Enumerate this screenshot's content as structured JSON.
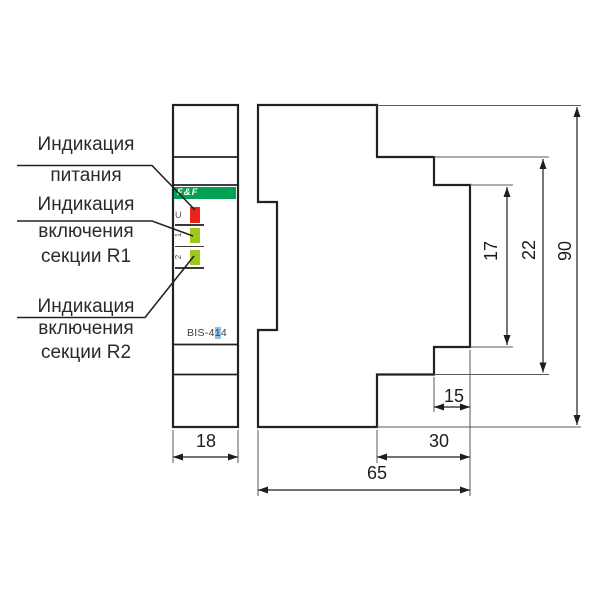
{
  "annotations": {
    "label_power": {
      "line1": "Индикация",
      "line2": "питания"
    },
    "label_r1": {
      "line1": "Индикация",
      "line2": "включения",
      "line3": "секции R1"
    },
    "label_r2": {
      "line1": "Индикация",
      "line2": "включения",
      "line3": "секции R2"
    }
  },
  "device": {
    "brand_logo": "F&F",
    "model_prefix": "BIS-4",
    "model_mid": "1",
    "model_suffix": "4",
    "led_u_label": "U",
    "led_r1_label": "1",
    "led_r2_label": "2",
    "colors": {
      "brand_green": "#00A151",
      "led_red": "#E8251D",
      "led_green": "#9DC81E",
      "model_highlight_blue": "#8CC0E8"
    }
  },
  "dimensions": {
    "front_width_mm": "18",
    "terminal_height_mm": "17",
    "step_height_mm": "22",
    "total_height_mm": "90",
    "terminal_depth_mm": "15",
    "rail_depth_mm": "30",
    "total_depth_mm": "65"
  }
}
